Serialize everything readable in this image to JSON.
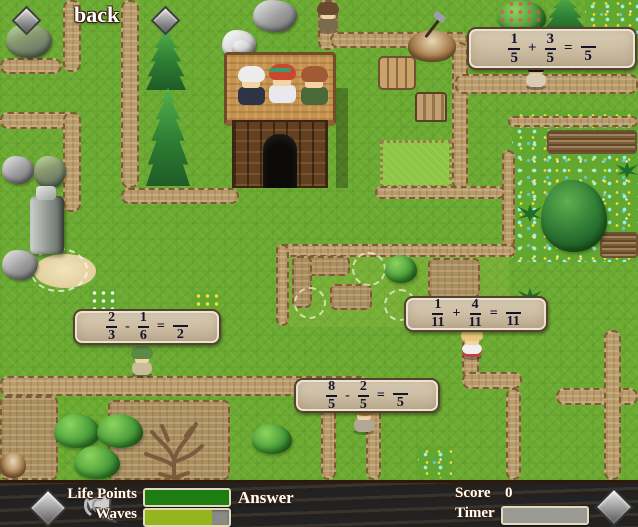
{
  "back_button": {
    "label": "back"
  },
  "problems": [
    {
      "n1": "1",
      "d1": "5",
      "op": "+",
      "n2": "3",
      "d2": "5",
      "eq": "=",
      "ans_den": "5"
    },
    {
      "n1": "2",
      "d1": "3",
      "op": "-",
      "n2": "1",
      "d2": "6",
      "eq": "=",
      "ans_den": "2"
    },
    {
      "n1": "1",
      "d1": "11",
      "op": "+",
      "n2": "4",
      "d2": "11",
      "eq": "=",
      "ans_den": "11"
    },
    {
      "n1": "8",
      "d1": "5",
      "op": "-",
      "n2": "2",
      "d2": "5",
      "eq": "=",
      "ans_den": "5"
    }
  ],
  "map": {
    "npcs": [
      "white-haired-elder",
      "red-haired-girl",
      "brown-haired-man"
    ],
    "enemies": [
      "soldier",
      "blonde-sunglasses-villager",
      "green-capped-villager",
      "white-dress-girl",
      "straw-hat-villager"
    ],
    "markers": [
      "diamond-marker",
      "diamond-marker"
    ]
  },
  "hud": {
    "life_points": {
      "label": "Life Points",
      "fill_pct": 100,
      "fill_color": "#1d7c12"
    },
    "waves": {
      "label": "Waves",
      "fill_pct": 80,
      "fill_color": "#94b51d"
    },
    "answer": {
      "label": "Answer"
    },
    "score": {
      "label": "Score",
      "value": "0"
    },
    "timer": {
      "label": "Timer",
      "fill_pct": 100,
      "fill_color": "#9a9a94"
    },
    "icons": [
      "diamond-icon",
      "megaphone-icon",
      "diamond-icon"
    ]
  },
  "colors": {
    "grass": "#6cab31",
    "path": "#b99c6c",
    "hud_wood": "#7a4a1e",
    "box_bg": "#cdbda2",
    "box_border": "#55432e",
    "flower_cyan": "#8ae8e0",
    "flower_yellow": "#ffd83a",
    "bar_border": "#e6d9bc",
    "bar_empty": "#8a8a84"
  }
}
